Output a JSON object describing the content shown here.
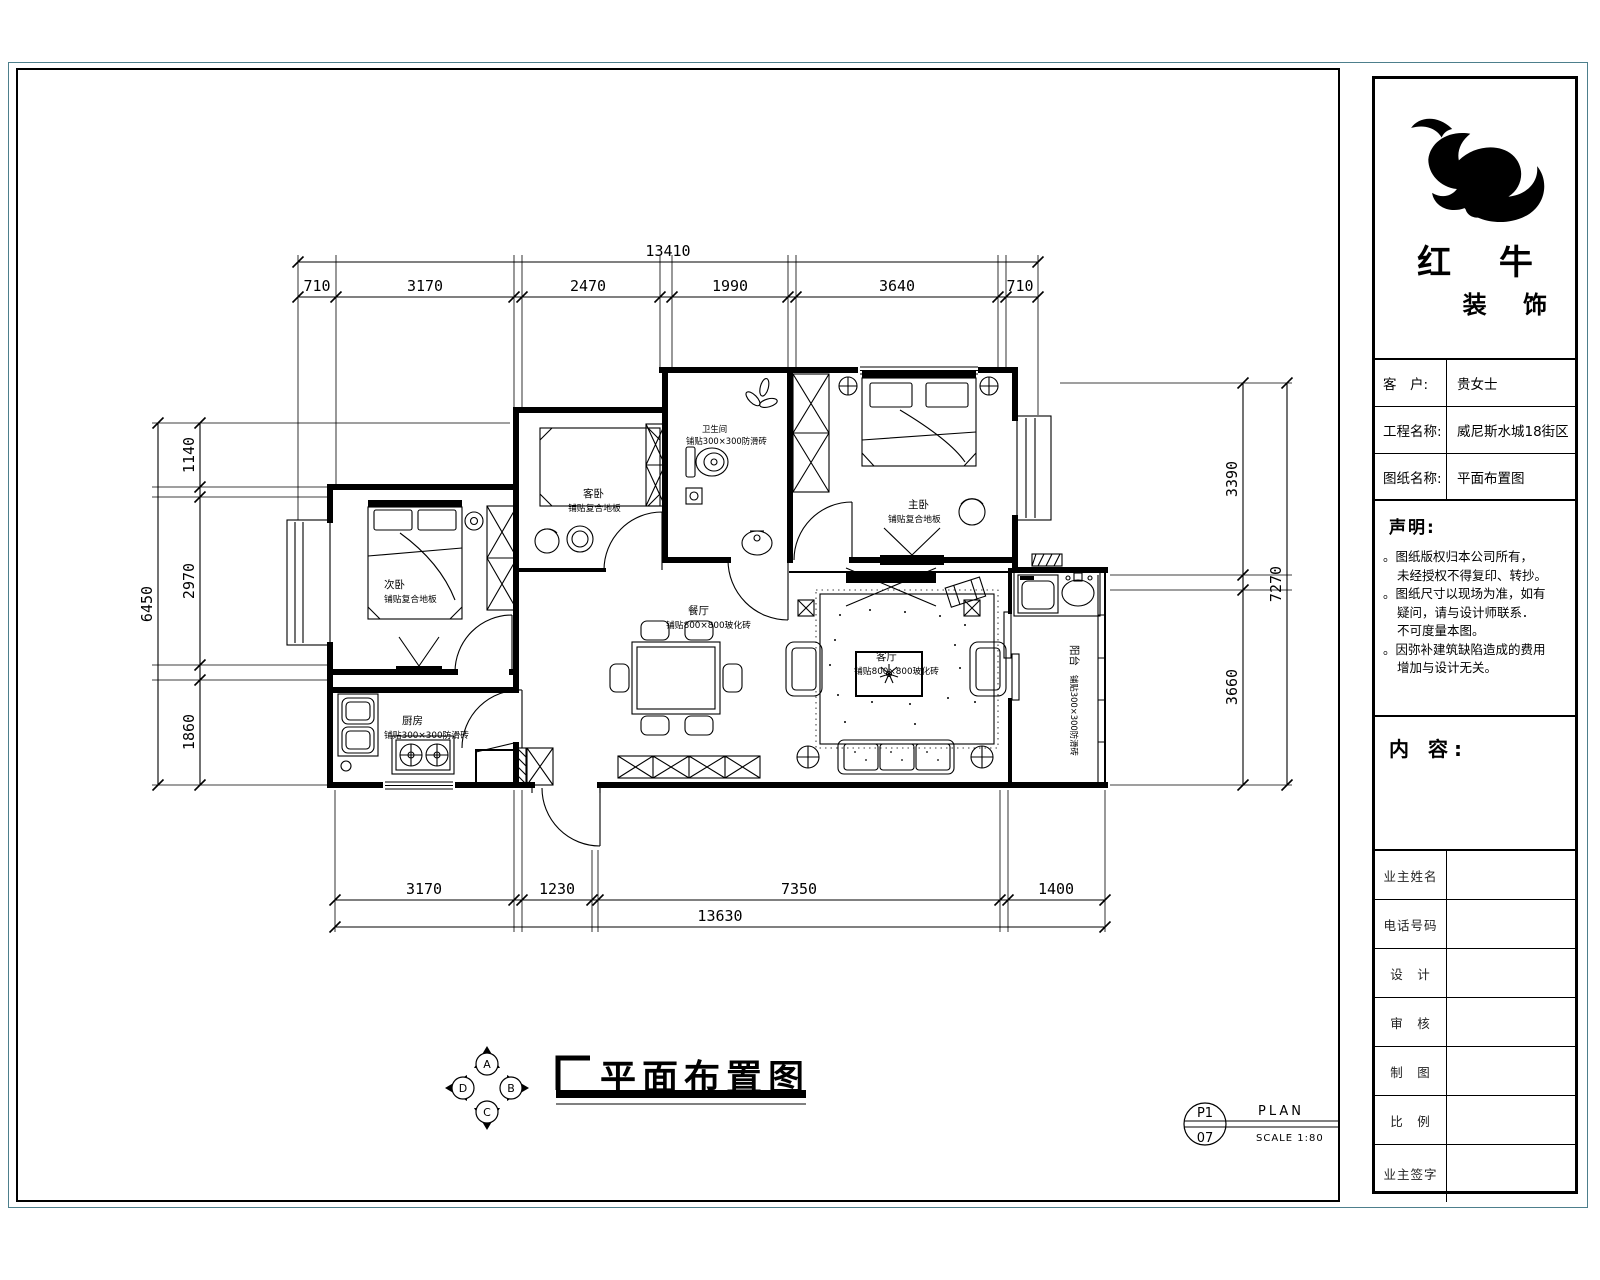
{
  "title_block": {
    "brand_line1": "红 牛",
    "brand_line2": "装 饰",
    "fields": [
      {
        "label": "客　户:",
        "value": "贵女士"
      },
      {
        "label": "工程名称:",
        "value": "威尼斯水城18街区"
      },
      {
        "label": "图纸名称:",
        "value": "平面布置图"
      }
    ],
    "statement_title": "声明:",
    "statement_lines": [
      "。图纸版权归本公司所有，",
      "未经授权不得复印、转抄。",
      "。图纸尺寸以现场为准，如有",
      "疑问，请与设计师联系．",
      "不可度量本图。",
      "。因弥补建筑缺陷造成的费用",
      "增加与设计无关。"
    ],
    "content_label": "内 容:",
    "sign_rows": [
      "业主姓名",
      "电话号码",
      "设　计",
      "审　核",
      "制　图",
      "比　例",
      "业主签字"
    ]
  },
  "rooms": {
    "second_bedroom": {
      "name": "次卧",
      "finish": "铺贴复合地板"
    },
    "guest_bedroom": {
      "name": "客卧",
      "finish": "铺贴复合地板"
    },
    "bathroom": {
      "name": "卫生间",
      "finish": "铺贴300×300防滑砖"
    },
    "master_bedroom": {
      "name": "主卧",
      "finish": "铺贴复合地板"
    },
    "dining": {
      "name": "餐厅",
      "finish": "铺贴800×800玻化砖"
    },
    "living": {
      "name": "客厅",
      "finish": "铺贴800×800玻化砖"
    },
    "kitchen": {
      "name": "厨房",
      "finish": "铺贴300×300防滑砖"
    },
    "balcony": {
      "name": "阳台",
      "finish": "铺贴300×300防滑砖"
    }
  },
  "dimensions": {
    "top": {
      "total": "13410",
      "segments": [
        "710",
        "3170",
        "2470",
        "1990",
        "3640",
        "710"
      ]
    },
    "bottom": {
      "total": "13630",
      "segments": [
        "3170",
        "1230",
        "7350",
        "1400"
      ]
    },
    "left": {
      "total": "6450",
      "segments": [
        "1140",
        "2970",
        "1860"
      ]
    },
    "right": {
      "total": "7270",
      "segments": [
        "3390",
        "3660"
      ]
    }
  },
  "footer": {
    "drawing_title": "平面布置图",
    "compass": {
      "top": "A",
      "right": "B",
      "bottom": "C",
      "left": "D"
    },
    "ref_number_top": "P1",
    "ref_number_bottom": "07",
    "ref_label": "PLAN",
    "ref_scale": "SCALE 1:80"
  },
  "colors": {
    "ink": "#000000",
    "outer_border": "#4d7f8c"
  }
}
